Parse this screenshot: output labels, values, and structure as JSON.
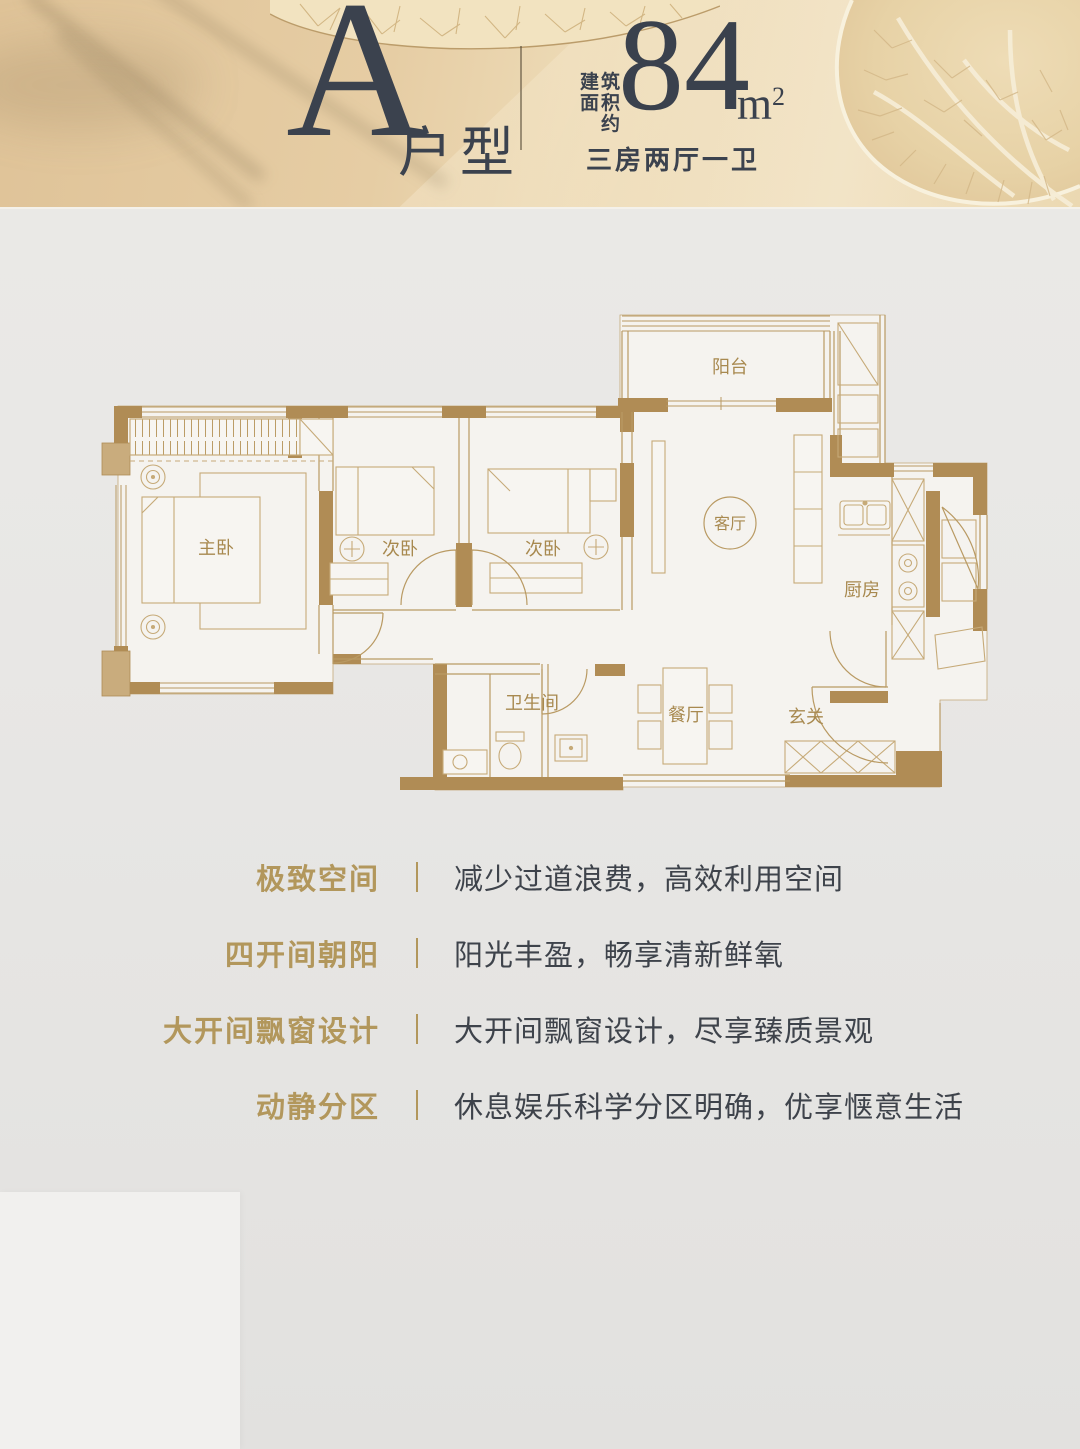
{
  "header": {
    "unit_letter": "A",
    "unit_type_label": "户型",
    "area_label_lines": [
      "建筑",
      "面积",
      "约"
    ],
    "area_value": "84",
    "area_unit_base": "m",
    "area_unit_exponent": "2",
    "layout_summary": "三房两厅一卫"
  },
  "floor_plan": {
    "rooms": {
      "balcony": "阳台",
      "living": "客厅",
      "master": "主卧",
      "bedroom2": "次卧",
      "bedroom3": "次卧",
      "kitchen": "厨房",
      "bathroom": "卫生间",
      "dining": "餐厅",
      "foyer": "玄关"
    }
  },
  "features": [
    {
      "label": "极致空间",
      "desc": "减少过道浪费，高效利用空间"
    },
    {
      "label": "四开间朝阳",
      "desc": "阳光丰盈，畅享清新鲜氧"
    },
    {
      "label": "大开间飘窗设计",
      "desc": "大开间飘窗设计，尽享臻质景观"
    },
    {
      "label": "动静分区",
      "desc": "休息娱乐科学分区明确，优享惬意生活"
    }
  ],
  "colors": {
    "header_text": "#3b424e",
    "wall_gold": "#b08c55",
    "line_gold": "#b99a63",
    "room_label_gold": "#a8894f",
    "feature_label_gold": "#b2975c",
    "feature_desc_text": "#3e434b"
  }
}
